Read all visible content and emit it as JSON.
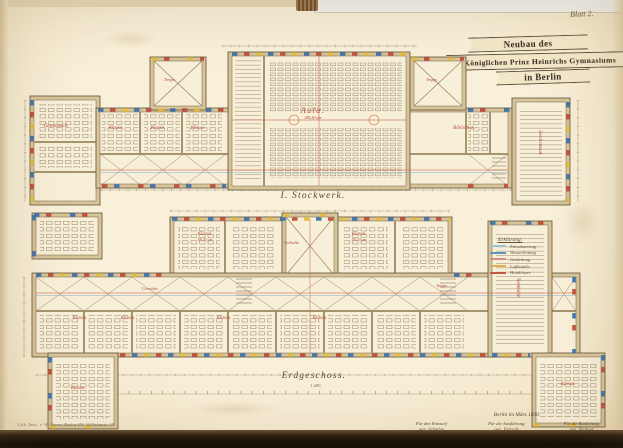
{
  "photo": {
    "sheet_label": "Blatt 2."
  },
  "title_banner": {
    "line1": "Neubau des",
    "line2": "Königlichen Prinz Heinrichs Gymnasiums",
    "line3": "in Berlin"
  },
  "plans": {
    "upper": {
      "caption": "I. Stockwerk.",
      "rooms": {
        "aula": {
          "label": "Aula.",
          "area": "286,40 qm"
        },
        "gesangsaal": {
          "label": "Gesangsaal."
        },
        "klasse1": {
          "label": "Klasse."
        },
        "klasse2": {
          "label": "Klasse."
        },
        "klasse3": {
          "label": "Klasse."
        },
        "bibliothek": {
          "label": "Bibliothek."
        },
        "zeichensaal": {
          "label": "Zeichensaal."
        },
        "treppe_l": {
          "label": "Treppe."
        },
        "treppe_r": {
          "label": "Treppe."
        }
      }
    },
    "lower": {
      "caption": "Erdgeschoss.",
      "rooms": {
        "vorhalle": {
          "label": "Vorhalle."
        },
        "klasse_a": {
          "label": "Klasse.",
          "area": "58,20 qm"
        },
        "klasse_b": {
          "label": "Klasse.",
          "area": "58,20 qm"
        },
        "corridor": {
          "label": "Corridor."
        },
        "klasse1": {
          "label": "Klasse."
        },
        "klasse2": {
          "label": "Klasse."
        },
        "klasse3": {
          "label": "Klasse."
        },
        "klasse4": {
          "label": "Klasse."
        },
        "turnhalle": {
          "label": "Turnhalle."
        },
        "klasse_sw": {
          "label": "Klasse."
        },
        "klasse_se": {
          "label": "Klasse."
        },
        "treppe": {
          "label": "Treppe."
        }
      }
    }
  },
  "legend": {
    "heading": "Erklärung:",
    "items": [
      {
        "label": "Entwässerung.",
        "color": "#9fc0d8"
      },
      {
        "label": "Wasserleitung.",
        "color": "#5f93c2"
      },
      {
        "label": "Gasleitung.",
        "color": "#d29288"
      },
      {
        "label": "Luftkanäle.",
        "color": "#dfae55"
      },
      {
        "label": "Heizkörper.",
        "color": "#bf5a48"
      }
    ]
  },
  "scale": {
    "label": "1:200."
  },
  "signatures": {
    "place_date": "Berlin im März 1890.",
    "columns": [
      {
        "heading": "Für den Entwurf:",
        "name": "gez. Schulze.",
        "title": "Königl. Baurath."
      },
      {
        "heading": "Für die Ausführung:",
        "name": "gez. Fritsch.",
        "title": "Königl. Landbauinspektor."
      },
      {
        "heading": "Für die Bauleitung:",
        "name": "gez. Reimer.",
        "title": "Königl. Reg. Baumeister."
      }
    ]
  },
  "credits": {
    "lithographer": "Lith. Anst. v. W. Greve, Berlin SW. Wilhelmstr. 29."
  },
  "palette": {
    "paper": "#f7edd6",
    "wall_poche": "#d8c499",
    "ink": "#6f6048",
    "red_ink": "#b5473a",
    "window_blue": "#3a6fae",
    "window_red": "#bf4a3a",
    "window_yellow": "#e0bc3f",
    "photo_edge": "#0e0a05"
  }
}
